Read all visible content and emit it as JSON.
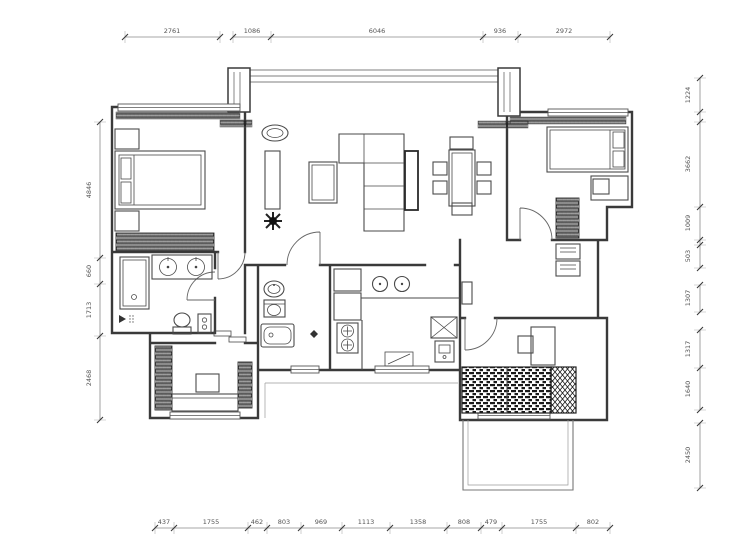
{
  "colors": {
    "wall": "#3a3a3a",
    "furniture_line": "#4a4a4a",
    "dimension_text": "#555555",
    "hatch": "#1a1a1a",
    "background": "#ffffff"
  },
  "dimensions": {
    "top": [
      "2761",
      "1086",
      "6046",
      "936",
      "2972"
    ],
    "bottom": [
      "437",
      "1755",
      "462",
      "803",
      "969",
      "1113",
      "1358",
      "808",
      "479",
      "1755",
      "802"
    ],
    "left": [
      "4846",
      "660",
      "1713",
      "2468"
    ],
    "right": [
      "1224",
      "3662",
      "1009",
      "503",
      "1307",
      "1317",
      "1640",
      "2450"
    ]
  }
}
